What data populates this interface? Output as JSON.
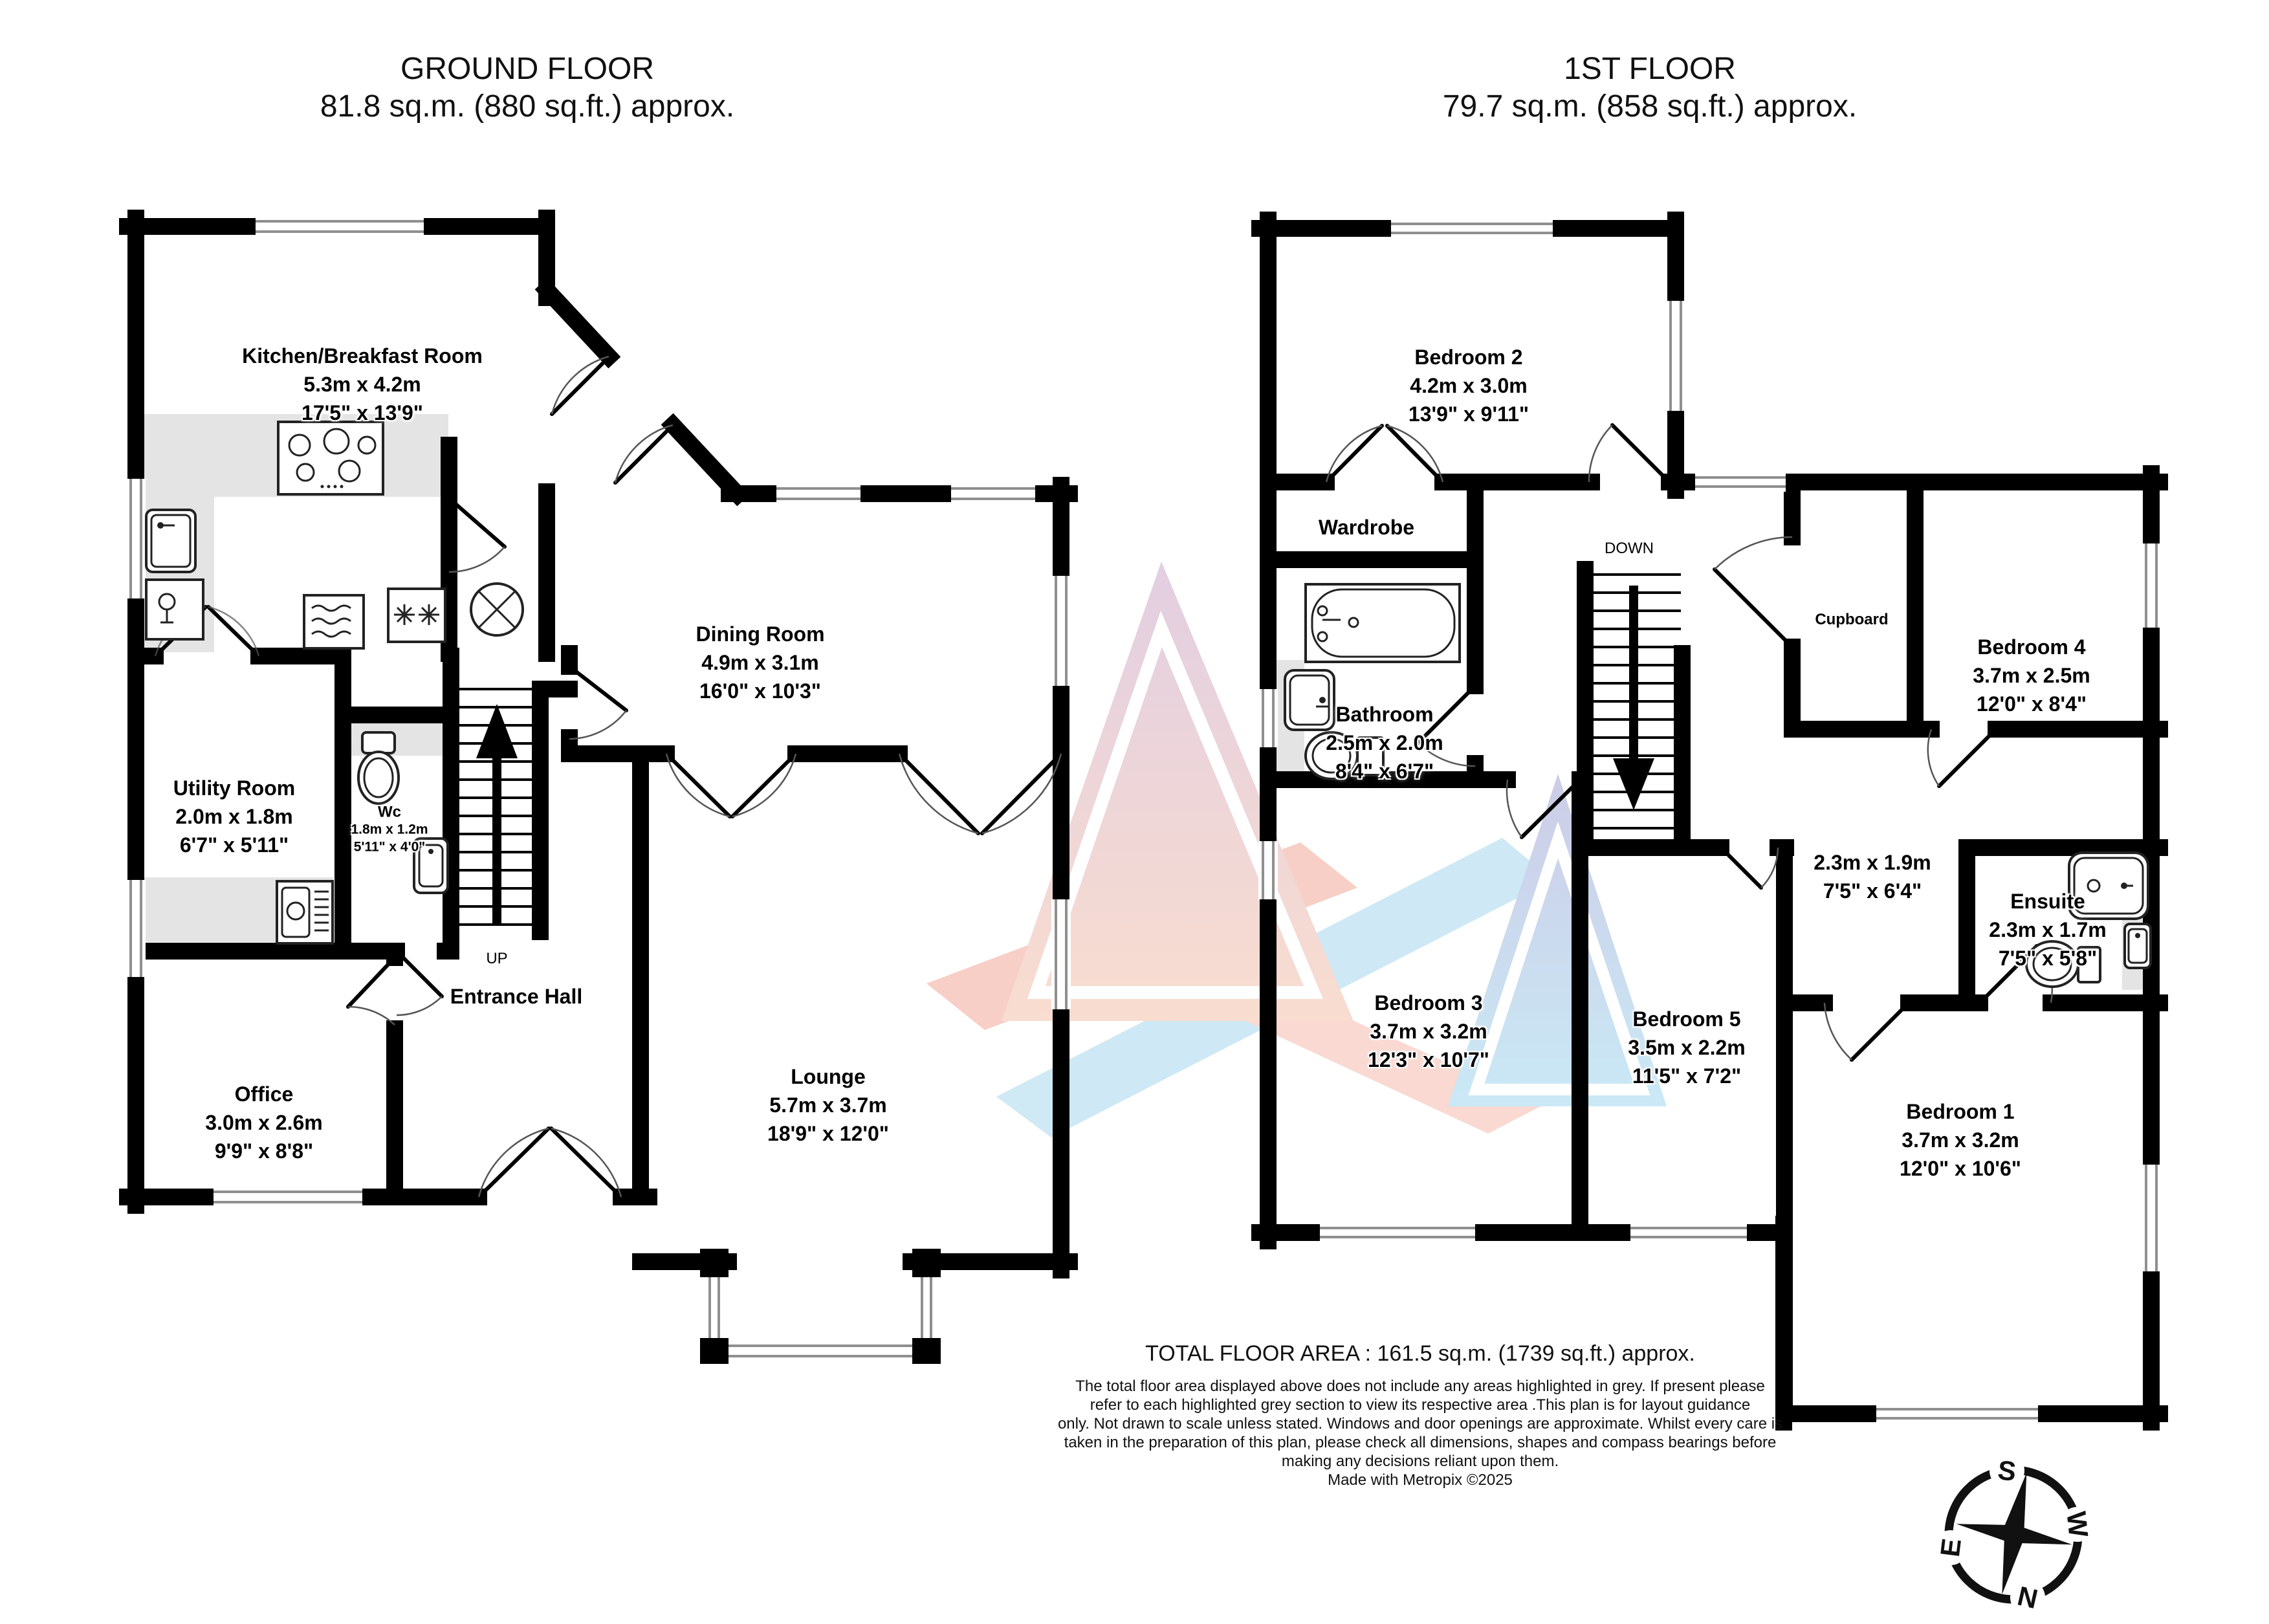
{
  "ground_floor": {
    "title": "GROUND FLOOR",
    "area": "81.8 sq.m. (880 sq.ft.) approx.",
    "stairs_label": "UP",
    "rooms": {
      "kitchen": {
        "name": "Kitchen/Breakfast Room",
        "metric": "5.3m  x 4.2m",
        "imperial": "17'5\"  x 13'9\""
      },
      "dining": {
        "name": "Dining Room",
        "metric": "4.9m  x 3.1m",
        "imperial": "16'0\"  x 10'3\""
      },
      "utility": {
        "name": "Utility Room",
        "metric": "2.0m  x 1.8m",
        "imperial": "6'7\"  x 5'11\""
      },
      "wc": {
        "name": "Wc",
        "metric": "1.8m  x 1.2m",
        "imperial": "5'11\"  x 4'0\""
      },
      "entrance": {
        "name": "Entrance Hall"
      },
      "office": {
        "name": "Office",
        "metric": "3.0m  x 2.6m",
        "imperial": "9'9\"  x 8'8\""
      },
      "lounge": {
        "name": "Lounge",
        "metric": "5.7m  x 3.7m",
        "imperial": "18'9\"  x 12'0\""
      }
    }
  },
  "first_floor": {
    "title": "1ST FLOOR",
    "area": "79.7 sq.m. (858 sq.ft.) approx.",
    "stairs_label": "DOWN",
    "rooms": {
      "bedroom2": {
        "name": "Bedroom 2",
        "metric": "4.2m  x 3.0m",
        "imperial": "13'9\"  x 9'11\""
      },
      "wardrobe": {
        "name": "Wardrobe"
      },
      "bathroom": {
        "name": "Bathroom",
        "metric": "2.5m  x 2.0m",
        "imperial": "8'4\"  x 6'7\""
      },
      "cupboard": {
        "name": "Cupboard"
      },
      "bedroom4": {
        "name": "Bedroom 4",
        "metric": "3.7m  x 2.5m",
        "imperial": "12'0\"  x 8'4\""
      },
      "landing": {
        "metric": "2.3m  x 1.9m",
        "imperial": "7'5\"  x 6'4\""
      },
      "ensuite": {
        "name": "Ensuite",
        "metric": "2.3m  x 1.7m",
        "imperial": "7'5\"  x 5'8\""
      },
      "bedroom3": {
        "name": "Bedroom 3",
        "metric": "3.7m  x 3.2m",
        "imperial": "12'3\"  x 10'7\""
      },
      "bedroom5": {
        "name": "Bedroom 5",
        "metric": "3.5m  x 2.2m",
        "imperial": "11'5\"  x 7'2\""
      },
      "bedroom1": {
        "name": "Bedroom 1",
        "metric": "3.7m  x 3.2m",
        "imperial": "12'0\"  x 10'6\""
      }
    }
  },
  "footer": {
    "total": "TOTAL FLOOR AREA : 161.5 sq.m. (1739 sq.ft.) approx.",
    "disclaimer_lines": [
      "The total floor area displayed above does not include any areas highlighted in grey. If present please",
      "refer to each highlighted grey section to view its respective area .This plan is for layout guidance",
      "only. Not drawn to scale unless stated. Windows and door openings are approximate. Whilst every care is",
      "taken in the preparation of this plan, please check all dimensions, shapes and compass bearings before",
      "making any decisions reliant upon them."
    ],
    "credit": "Made with Metropix ©2025"
  },
  "compass": {
    "n": "N",
    "s": "S",
    "e": "E",
    "w": "W"
  }
}
